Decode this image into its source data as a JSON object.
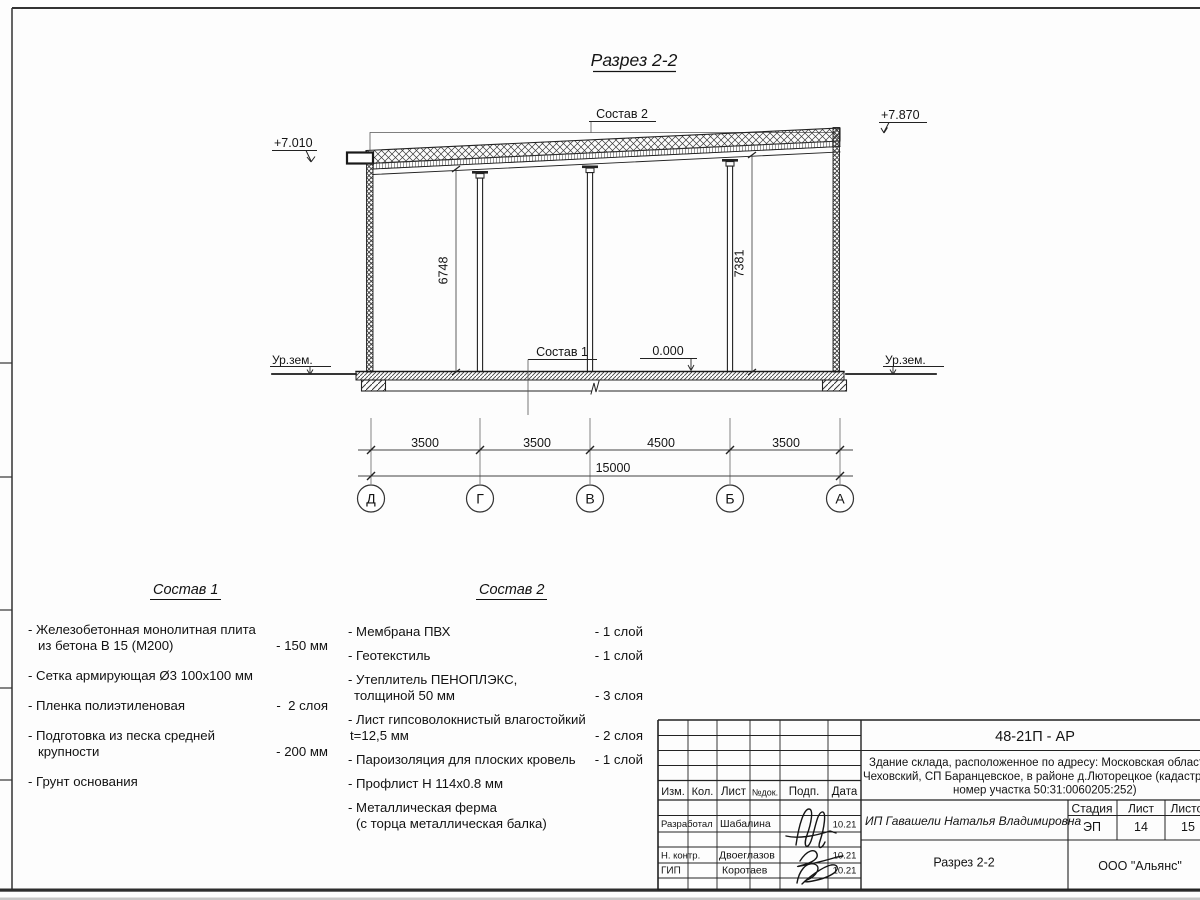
{
  "drawing": {
    "title": "Разрез 2-2",
    "elev_left": "+7.010",
    "elev_right": "+7.870",
    "elev_zero": "0.000",
    "ground_left": "Ур.зем.",
    "ground_right": "Ур.зем.",
    "comp1_ref": "Состав 1",
    "comp2_ref": "Состав 2",
    "height_left": "6748",
    "height_right": "7381",
    "span_dims": [
      "3500",
      "3500",
      "4500",
      "3500"
    ],
    "total_dim": "15000",
    "axes": [
      "Д",
      "Г",
      "В",
      "Б",
      "А"
    ]
  },
  "comp1": {
    "title": "Состав 1",
    "items": [
      {
        "line1": "- Железобетонная  монолитная плита",
        "line2": "из бетона В 15 (М200)",
        "value": "- 150 мм"
      },
      {
        "line1": "- Сетка армирующая Ø3 100х100 мм",
        "line2": "",
        "value": ""
      },
      {
        "line1": "- Пленка полиэтиленовая",
        "line2": "",
        "value": "-  2 слоя"
      },
      {
        "line1": "- Подготовка из песка средней",
        "line2": "крупности",
        "value": "- 200 мм"
      },
      {
        "line1": "- Грунт основания",
        "line2": "",
        "value": ""
      }
    ]
  },
  "comp2": {
    "title": "Состав 2",
    "items": [
      {
        "line1": "- Мембрана ПВХ",
        "line2": "",
        "value": "- 1 слой"
      },
      {
        "line1": "- Геотекстиль",
        "line2": "",
        "value": "- 1 слой"
      },
      {
        "line1": "- Утеплитель ПЕНОПЛЭКС,",
        "line2": "толщиной 50 мм",
        "value": "- 3 слоя"
      },
      {
        "line1": "- Лист гипсоволокнистый влагостойкий",
        "line2": "t=12,5 мм",
        "value": "- 2 слоя"
      },
      {
        "line1": "- Пароизоляция для плоских кровель",
        "line2": "",
        "value": "- 1 слой"
      },
      {
        "line1": "- Профлист Н 114х0.8 мм",
        "line2": "",
        "value": ""
      },
      {
        "line1": "- Металлическая ферма",
        "line2": "(с торца металлическая балка)",
        "value": ""
      }
    ]
  },
  "titleblock": {
    "doc_code": "48-21П - АР",
    "object_line1": "Здание склада, расположенное по адресу: Московская область, р",
    "object_line2": "Чеховский, СП Баранцевское, в районе д.Люторецкое  (кадастровы",
    "object_line3": "номер участка 50:31:0060205:252)",
    "client": "ИП Гавашели Наталья Владимировна",
    "sheet_title": "Разрез 2-2",
    "company": "ООО \"Альянс\"",
    "stage_label": "Стадия",
    "sheet_label": "Лист",
    "sheets_label": "Листов",
    "stage": "ЭП",
    "sheet_num": "14",
    "sheets_total": "15",
    "col_izm": "Изм.",
    "col_kol": "Кол.",
    "col_list": "Лист",
    "col_ndoc": "№док.",
    "col_podp": "Подп.",
    "col_data": "Дата",
    "rows": [
      {
        "role": "Разработал",
        "name": "Шабалина",
        "date": "10.21"
      },
      {
        "role": "Н. контр.",
        "name": "Двоеглазов",
        "date": "10.21"
      },
      {
        "role": "ГИП",
        "name": "Коротаев",
        "date": "10.21"
      }
    ]
  }
}
